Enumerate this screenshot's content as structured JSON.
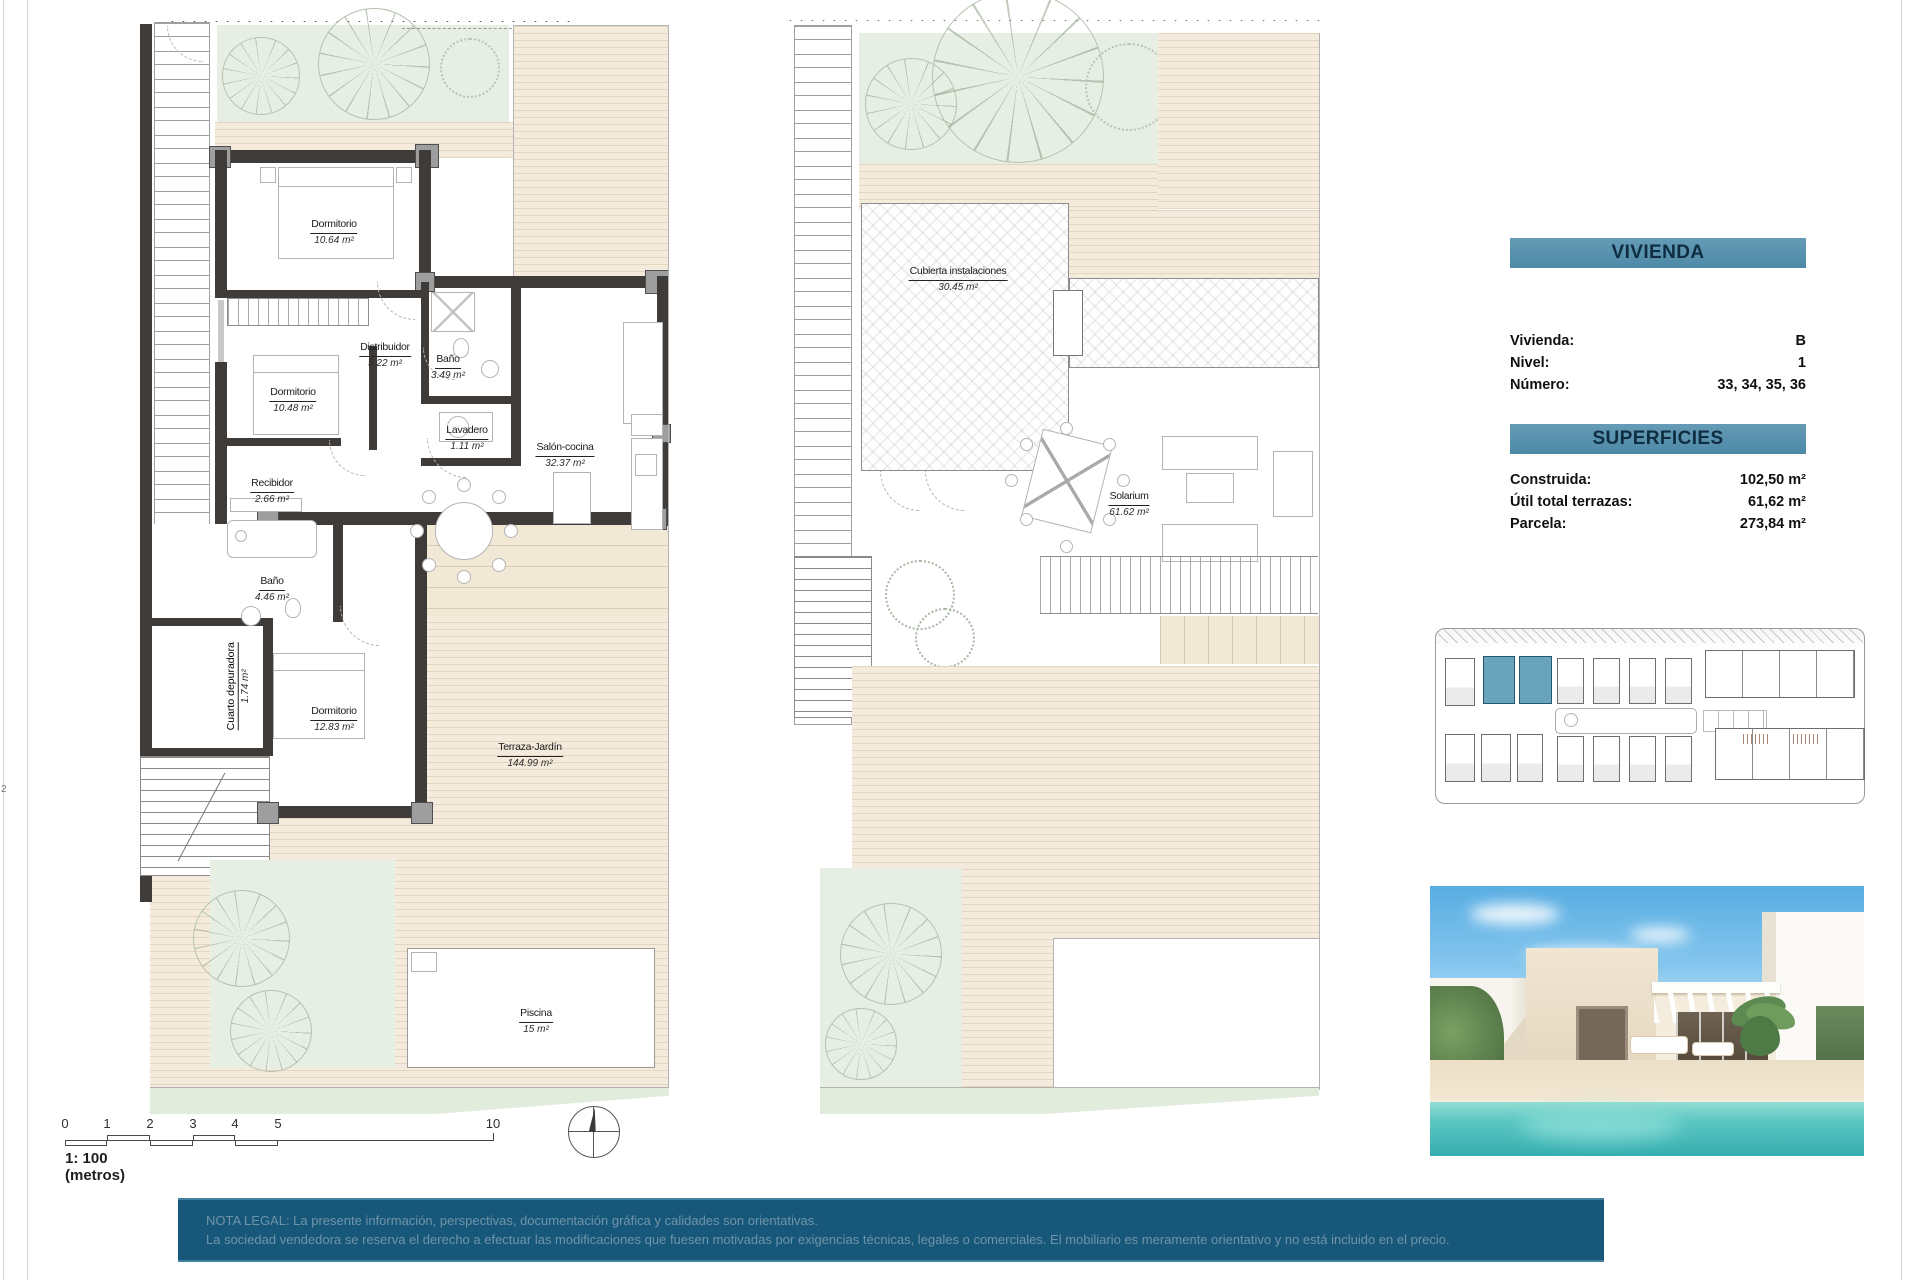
{
  "page": {
    "edge_mark": "2"
  },
  "plan_ground": {
    "rooms": [
      {
        "name": "Dormitorio",
        "area": "10.64 m²"
      },
      {
        "name": "Distribuidor",
        "area": "5.22 m²"
      },
      {
        "name": "Baño",
        "area": "3.49 m²"
      },
      {
        "name": "Dormitorio",
        "area": "10.48 m²"
      },
      {
        "name": "Lavadero",
        "area": "1.11 m²"
      },
      {
        "name": "Salón-cocina",
        "area": "32.37 m²"
      },
      {
        "name": "Recibidor",
        "area": "2.66 m²"
      },
      {
        "name": "Baño",
        "area": "4.46 m²"
      },
      {
        "name": "Cuarto depuradora",
        "area": "1.74 m²"
      },
      {
        "name": "Dormitorio",
        "area": "12.83 m²"
      },
      {
        "name": "Terraza-Jardín",
        "area": "144.99 m²"
      },
      {
        "name": "Piscina",
        "area": "15 m²"
      }
    ]
  },
  "plan_solarium": {
    "rooms": [
      {
        "name": "Cubierta instalaciones",
        "area": "30.45 m²"
      },
      {
        "name": "Solarium",
        "area": "61.62 m²"
      }
    ]
  },
  "scale_bar": {
    "ticks": [
      "0",
      "1",
      "2",
      "3",
      "4",
      "5",
      "10"
    ],
    "label": "1: 100 (metros)"
  },
  "info_panel": {
    "vivienda_title": "VIVIENDA",
    "vivienda_rows": [
      {
        "label": "Vivienda:",
        "value": "B"
      },
      {
        "label": "Nivel:",
        "value": "1"
      },
      {
        "label": "Número:",
        "value": "33, 34, 35, 36"
      }
    ],
    "superficies_title": "SUPERFICIES",
    "superficies_rows": [
      {
        "label": "Construida:",
        "value": "102,50 m²"
      },
      {
        "label": "Útil total terrazas:",
        "value": "61,62 m²"
      },
      {
        "label": "Parcela:",
        "value": "273,84 m²"
      }
    ]
  },
  "legal_note": {
    "line1": "NOTA LEGAL: La presente información, perspectivas, documentación gráfica y calidades son orientativas.",
    "line2": "La sociedad vendedora se reserva el derecho a efectuar las modificaciones que fuesen motivadas por exigencias técnicas, legales o comerciales. El mobiliario es meramente orientativo y no está incluido en el precio."
  },
  "colors": {
    "accent_teal": "#5590ad",
    "legal_bar": "#17587a",
    "site_highlight": "#68a5bd",
    "pool_water": "#4fc0bd",
    "wall": "#3e3b39",
    "deck_beige": "#f4ebdc",
    "garden_green": "#e7eee3"
  }
}
